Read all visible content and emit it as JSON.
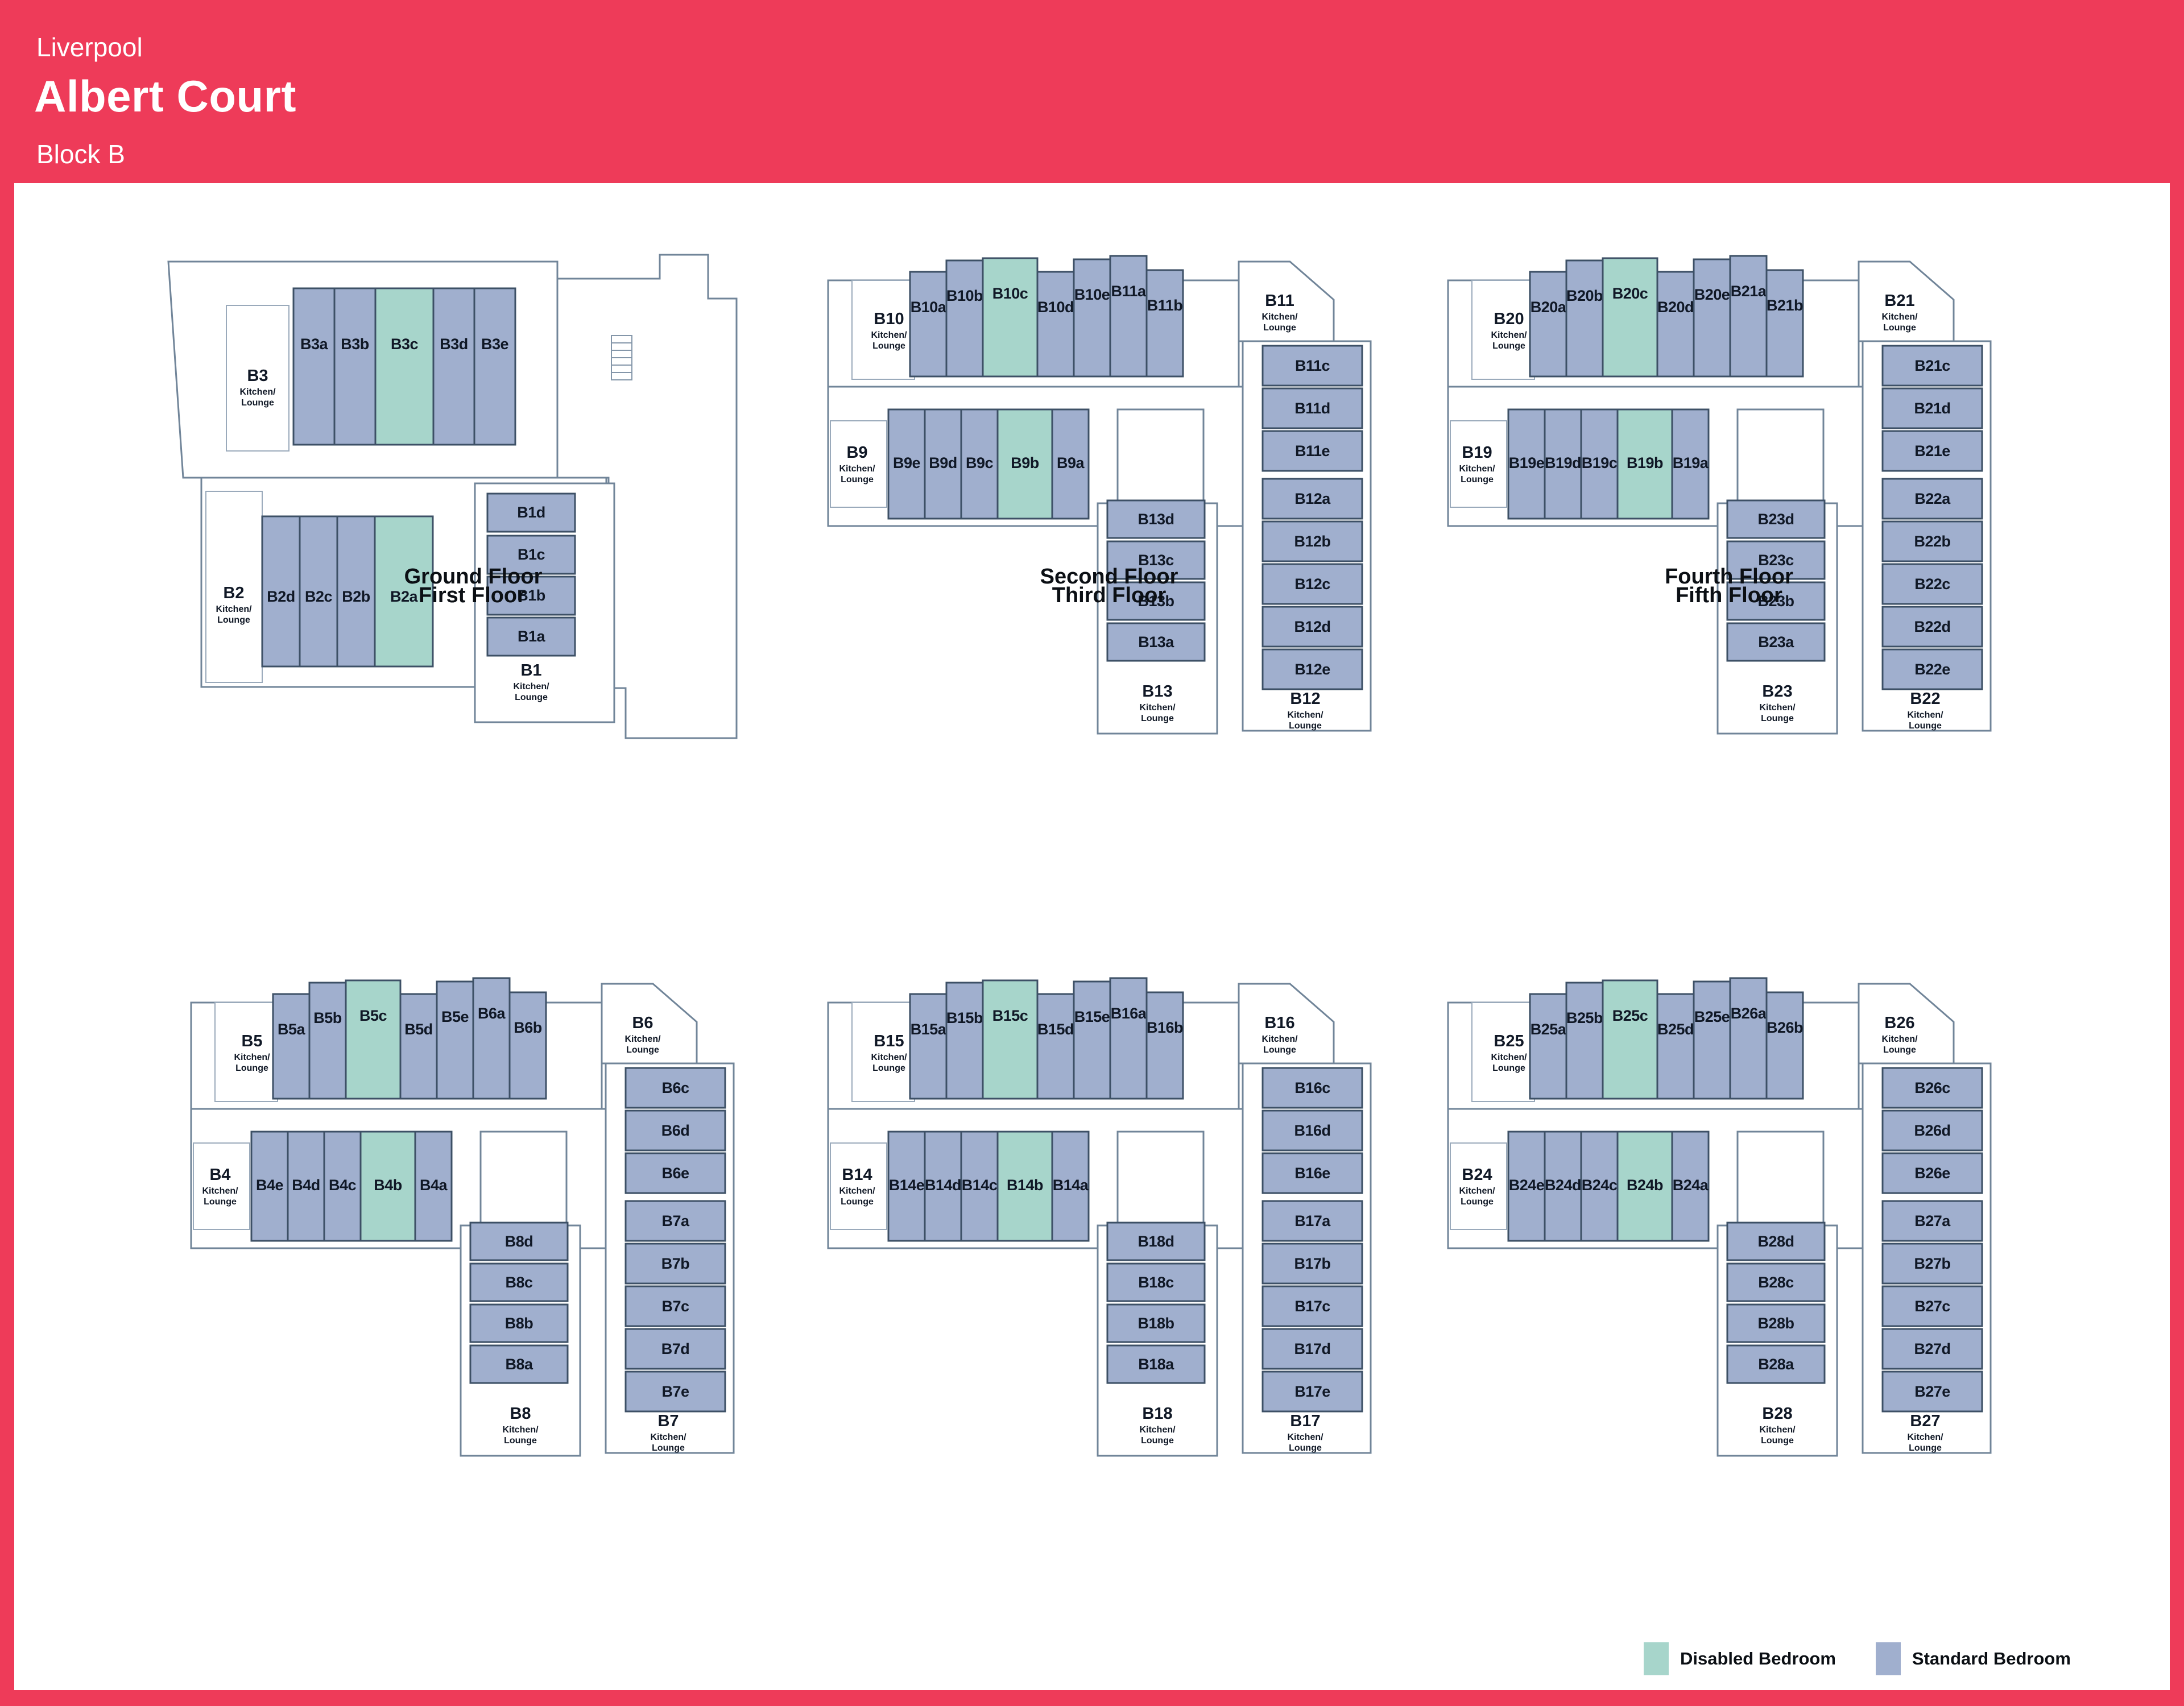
{
  "header": {
    "city": "Liverpool",
    "building": "Albert Court",
    "block": "Block B"
  },
  "kitchen_sub": [
    "Kitchen/",
    "Lounge"
  ],
  "legend": {
    "items": [
      {
        "label": "Disabled Bedroom",
        "type": "disabled"
      },
      {
        "label": "Standard Bedroom",
        "type": "standard"
      }
    ]
  },
  "colors": {
    "accent": "#EE3B59",
    "standard_room": "#A0AFCE",
    "disabled_room": "#A7D5CB",
    "building_wall": "#718599",
    "room_border": "#3D5066"
  },
  "floors": [
    {
      "id": "ground",
      "title": "Ground Floor",
      "variant": "ground",
      "top_flat": {
        "kitchen": "B3",
        "rooms": [
          {
            "name": "B3a",
            "type": "standard"
          },
          {
            "name": "B3b",
            "type": "standard"
          },
          {
            "name": "B3c",
            "type": "disabled"
          },
          {
            "name": "B3d",
            "type": "standard"
          },
          {
            "name": "B3e",
            "type": "standard"
          }
        ]
      },
      "mid_flat": {
        "kitchen": "B2",
        "rooms": [
          {
            "name": "B2d",
            "type": "standard"
          },
          {
            "name": "B2c",
            "type": "standard"
          },
          {
            "name": "B2b",
            "type": "standard"
          },
          {
            "name": "B2a",
            "type": "disabled"
          }
        ]
      },
      "column_flat": {
        "kitchen": "B1",
        "rooms": [
          {
            "name": "B1d",
            "type": "standard"
          },
          {
            "name": "B1c",
            "type": "standard"
          },
          {
            "name": "B1b",
            "type": "standard"
          },
          {
            "name": "B1a",
            "type": "standard"
          }
        ]
      }
    },
    {
      "id": "second",
      "title": "Second Floor",
      "variant": "standard",
      "top_flat": {
        "kitchen": "B10",
        "rooms": [
          {
            "name": "B10a",
            "type": "standard"
          },
          {
            "name": "B10b",
            "type": "standard"
          },
          {
            "name": "B10c",
            "type": "disabled"
          },
          {
            "name": "B10d",
            "type": "standard"
          },
          {
            "name": "B10e",
            "type": "standard"
          }
        ]
      },
      "top_flat_extra": {
        "kitchen": "B11",
        "rooms": [
          {
            "name": "B11a",
            "type": "standard"
          },
          {
            "name": "B11b",
            "type": "standard"
          }
        ]
      },
      "mid_flat": {
        "kitchen": "B9",
        "rooms": [
          {
            "name": "B9e",
            "type": "standard"
          },
          {
            "name": "B9d",
            "type": "standard"
          },
          {
            "name": "B9c",
            "type": "standard"
          },
          {
            "name": "B9b",
            "type": "disabled"
          },
          {
            "name": "B9a",
            "type": "standard"
          }
        ]
      },
      "right_column": {
        "kitchen": "B12",
        "rooms": [
          {
            "name": "B11c",
            "type": "standard"
          },
          {
            "name": "B11d",
            "type": "standard"
          },
          {
            "name": "B11e",
            "type": "standard"
          },
          {
            "name": "B12a",
            "type": "standard"
          },
          {
            "name": "B12b",
            "type": "standard"
          },
          {
            "name": "B12c",
            "type": "standard"
          },
          {
            "name": "B12d",
            "type": "standard"
          },
          {
            "name": "B12e",
            "type": "standard"
          }
        ]
      },
      "center_column": {
        "kitchen": "B13",
        "rooms": [
          {
            "name": "B13d",
            "type": "standard"
          },
          {
            "name": "B13c",
            "type": "standard"
          },
          {
            "name": "B13b",
            "type": "standard"
          },
          {
            "name": "B13a",
            "type": "standard"
          }
        ]
      }
    },
    {
      "id": "fourth",
      "title": "Fourth Floor",
      "variant": "standard",
      "top_flat": {
        "kitchen": "B20",
        "rooms": [
          {
            "name": "B20a",
            "type": "standard"
          },
          {
            "name": "B20b",
            "type": "standard"
          },
          {
            "name": "B20c",
            "type": "disabled"
          },
          {
            "name": "B20d",
            "type": "standard"
          },
          {
            "name": "B20e",
            "type": "standard"
          }
        ]
      },
      "top_flat_extra": {
        "kitchen": "B21",
        "rooms": [
          {
            "name": "B21a",
            "type": "standard"
          },
          {
            "name": "B21b",
            "type": "standard"
          }
        ]
      },
      "mid_flat": {
        "kitchen": "B19",
        "rooms": [
          {
            "name": "B19e",
            "type": "standard"
          },
          {
            "name": "B19d",
            "type": "standard"
          },
          {
            "name": "B19c",
            "type": "standard"
          },
          {
            "name": "B19b",
            "type": "disabled"
          },
          {
            "name": "B19a",
            "type": "standard"
          }
        ]
      },
      "right_column": {
        "kitchen": "B22",
        "rooms": [
          {
            "name": "B21c",
            "type": "standard"
          },
          {
            "name": "B21d",
            "type": "standard"
          },
          {
            "name": "B21e",
            "type": "standard"
          },
          {
            "name": "B22a",
            "type": "standard"
          },
          {
            "name": "B22b",
            "type": "standard"
          },
          {
            "name": "B22c",
            "type": "standard"
          },
          {
            "name": "B22d",
            "type": "standard"
          },
          {
            "name": "B22e",
            "type": "standard"
          }
        ]
      },
      "center_column": {
        "kitchen": "B23",
        "rooms": [
          {
            "name": "B23d",
            "type": "standard"
          },
          {
            "name": "B23c",
            "type": "standard"
          },
          {
            "name": "B23b",
            "type": "standard"
          },
          {
            "name": "B23a",
            "type": "standard"
          }
        ]
      }
    },
    {
      "id": "first",
      "title": "First Floor",
      "variant": "standard",
      "top_flat": {
        "kitchen": "B5",
        "rooms": [
          {
            "name": "B5a",
            "type": "standard"
          },
          {
            "name": "B5b",
            "type": "standard"
          },
          {
            "name": "B5c",
            "type": "disabled"
          },
          {
            "name": "B5d",
            "type": "standard"
          },
          {
            "name": "B5e",
            "type": "standard"
          }
        ]
      },
      "top_flat_extra": {
        "kitchen": "B6",
        "rooms": [
          {
            "name": "B6a",
            "type": "standard"
          },
          {
            "name": "B6b",
            "type": "standard"
          }
        ]
      },
      "mid_flat": {
        "kitchen": "B4",
        "rooms": [
          {
            "name": "B4e",
            "type": "standard"
          },
          {
            "name": "B4d",
            "type": "standard"
          },
          {
            "name": "B4c",
            "type": "standard"
          },
          {
            "name": "B4b",
            "type": "disabled"
          },
          {
            "name": "B4a",
            "type": "standard"
          }
        ]
      },
      "right_column": {
        "kitchen": "B7",
        "rooms": [
          {
            "name": "B6c",
            "type": "standard"
          },
          {
            "name": "B6d",
            "type": "standard"
          },
          {
            "name": "B6e",
            "type": "standard"
          },
          {
            "name": "B7a",
            "type": "standard"
          },
          {
            "name": "B7b",
            "type": "standard"
          },
          {
            "name": "B7c",
            "type": "standard"
          },
          {
            "name": "B7d",
            "type": "standard"
          },
          {
            "name": "B7e",
            "type": "standard"
          }
        ]
      },
      "center_column": {
        "kitchen": "B8",
        "rooms": [
          {
            "name": "B8d",
            "type": "standard"
          },
          {
            "name": "B8c",
            "type": "standard"
          },
          {
            "name": "B8b",
            "type": "standard"
          },
          {
            "name": "B8a",
            "type": "standard"
          }
        ]
      }
    },
    {
      "id": "third",
      "title": "Third Floor",
      "variant": "standard",
      "top_flat": {
        "kitchen": "B15",
        "rooms": [
          {
            "name": "B15a",
            "type": "standard"
          },
          {
            "name": "B15b",
            "type": "standard"
          },
          {
            "name": "B15c",
            "type": "disabled"
          },
          {
            "name": "B15d",
            "type": "standard"
          },
          {
            "name": "B15e",
            "type": "standard"
          }
        ]
      },
      "top_flat_extra": {
        "kitchen": "B16",
        "rooms": [
          {
            "name": "B16a",
            "type": "standard"
          },
          {
            "name": "B16b",
            "type": "standard"
          }
        ]
      },
      "mid_flat": {
        "kitchen": "B14",
        "rooms": [
          {
            "name": "B14e",
            "type": "standard"
          },
          {
            "name": "B14d",
            "type": "standard"
          },
          {
            "name": "B14c",
            "type": "standard"
          },
          {
            "name": "B14b",
            "type": "disabled"
          },
          {
            "name": "B14a",
            "type": "standard"
          }
        ]
      },
      "right_column": {
        "kitchen": "B17",
        "rooms": [
          {
            "name": "B16c",
            "type": "standard"
          },
          {
            "name": "B16d",
            "type": "standard"
          },
          {
            "name": "B16e",
            "type": "standard"
          },
          {
            "name": "B17a",
            "type": "standard"
          },
          {
            "name": "B17b",
            "type": "standard"
          },
          {
            "name": "B17c",
            "type": "standard"
          },
          {
            "name": "B17d",
            "type": "standard"
          },
          {
            "name": "B17e",
            "type": "standard"
          }
        ]
      },
      "center_column": {
        "kitchen": "B18",
        "rooms": [
          {
            "name": "B18d",
            "type": "standard"
          },
          {
            "name": "B18c",
            "type": "standard"
          },
          {
            "name": "B18b",
            "type": "standard"
          },
          {
            "name": "B18a",
            "type": "standard"
          }
        ]
      }
    },
    {
      "id": "fifth",
      "title": "Fifth Floor",
      "variant": "standard",
      "top_flat": {
        "kitchen": "B25",
        "rooms": [
          {
            "name": "B25a",
            "type": "standard"
          },
          {
            "name": "B25b",
            "type": "standard"
          },
          {
            "name": "B25c",
            "type": "disabled"
          },
          {
            "name": "B25d",
            "type": "standard"
          },
          {
            "name": "B25e",
            "type": "standard"
          }
        ]
      },
      "top_flat_extra": {
        "kitchen": "B26",
        "rooms": [
          {
            "name": "B26a",
            "type": "standard"
          },
          {
            "name": "B26b",
            "type": "standard"
          }
        ]
      },
      "mid_flat": {
        "kitchen": "B24",
        "rooms": [
          {
            "name": "B24e",
            "type": "standard"
          },
          {
            "name": "B24d",
            "type": "standard"
          },
          {
            "name": "B24c",
            "type": "standard"
          },
          {
            "name": "B24b",
            "type": "disabled"
          },
          {
            "name": "B24a",
            "type": "standard"
          }
        ]
      },
      "right_column": {
        "kitchen": "B27",
        "rooms": [
          {
            "name": "B26c",
            "type": "standard"
          },
          {
            "name": "B26d",
            "type": "standard"
          },
          {
            "name": "B26e",
            "type": "standard"
          },
          {
            "name": "B27a",
            "type": "standard"
          },
          {
            "name": "B27b",
            "type": "standard"
          },
          {
            "name": "B27c",
            "type": "standard"
          },
          {
            "name": "B27d",
            "type": "standard"
          },
          {
            "name": "B27e",
            "type": "standard"
          }
        ]
      },
      "center_column": {
        "kitchen": "B28",
        "rooms": [
          {
            "name": "B28d",
            "type": "standard"
          },
          {
            "name": "B28c",
            "type": "standard"
          },
          {
            "name": "B28b",
            "type": "standard"
          },
          {
            "name": "B28a",
            "type": "standard"
          }
        ]
      }
    }
  ]
}
